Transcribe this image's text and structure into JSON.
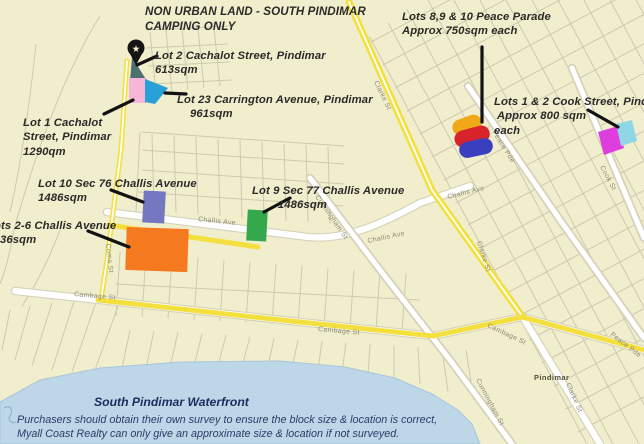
{
  "map_title": "NON URBAN LAND - SOUTH PINDIMAR\nCAMPING ONLY",
  "annotations": {
    "lot2_cachalot": "Lot 2 Cachalot Street, Pindimar\n613sqm",
    "lot23_carrington": "Lot 23 Carrington Avenue, Pindimar\n    961sqm",
    "lot1_cachalot": "Lot 1 Cachalot\nStreet, Pindimar\n1290qm",
    "lot10_sec76": "Lot 10 Sec 76 Challis Avenue\n1486sqm",
    "lot9_sec77": "Lot 9 Sec 77 Challis Avenue\n        1486sqm",
    "lots26_challis": "Lots 2-6 Challis Avenue\n    36sqm",
    "lots8910_peace": "Lots 8,9 & 10 Peace Parade\nApprox 750sqm each",
    "lots12_cook": "Lots 1 & 2 Cook Street, Pindimar\n Approx 800 sqm\neach"
  },
  "streets": {
    "clarke": "Clarke St",
    "coma": "Coma St",
    "challis": "Challis Ave",
    "cunningham": "Cunningham St",
    "cambage": "Cambage St",
    "peace": "Peace Pde",
    "cook": "Cook St",
    "pindimar": "Pindimar"
  },
  "footer": {
    "heading": "South Pindimar Waterfront",
    "disclaimer": "Purchasers should obtain their own survey to ensure the block size & location is correct,\nMyall Coast Realty can only give an approximate size & location if not surveyed."
  },
  "icons": {
    "pin_star": "★"
  },
  "colors": {
    "land": "#f1eecd",
    "water": "#bdd6e8",
    "route_highlight": "#f3df3e",
    "road": "#ffffff",
    "lot2_teal": "#4d6f6e",
    "lot1_pink": "#f7b6d8",
    "lot23_blue": "#2aa0d8",
    "lot10_purple": "#7577c0",
    "lot9_green": "#35a74d",
    "lots26_orange": "#f4791f",
    "peace_yellow": "#f0a818",
    "peace_red": "#d8232a",
    "peace_blue": "#3a3fbe",
    "cook_magenta": "#df3edf",
    "cook_cyan": "#8fd6e6",
    "annotation_text": "#2b2a28",
    "waterfront_text": "#1d2b5f"
  }
}
